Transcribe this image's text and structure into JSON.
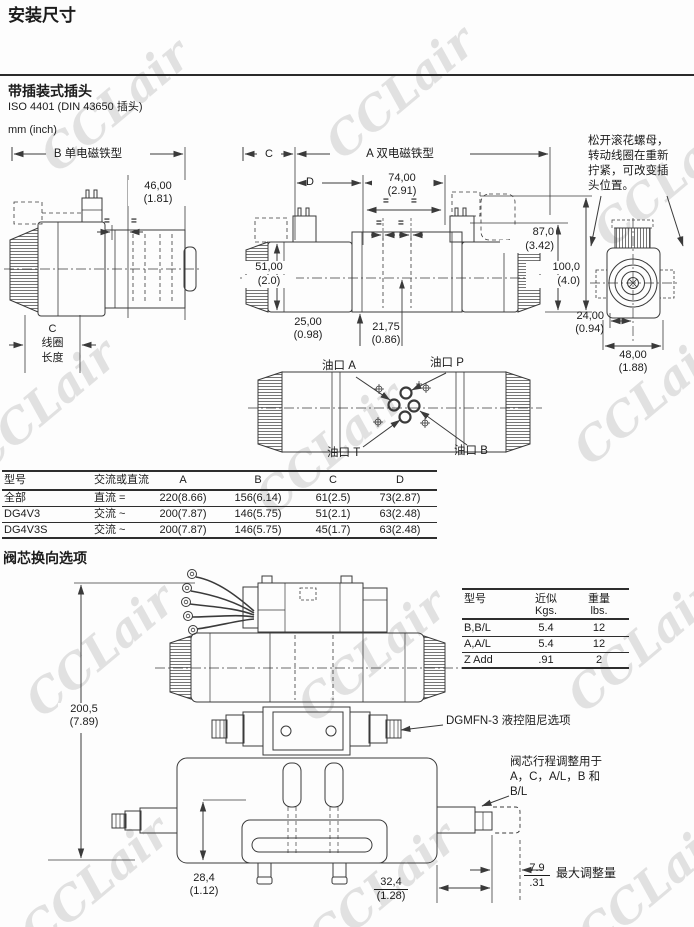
{
  "page": {
    "title": "安装尺寸",
    "watermark": "CCLair"
  },
  "section1": {
    "heading": "带插装式插头",
    "standard": "ISO 4401 (DIN 43650 插头)",
    "units": "mm (inch)",
    "fig_single": {
      "label": "B 单电磁铁型",
      "dim46": "46,00",
      "dim46_in": "(1.81)",
      "eq": "=",
      "coil_c": "C",
      "coil_line1": "线圈",
      "coil_line2": "长度"
    },
    "fig_double": {
      "label": "A 双电磁铁型",
      "dim_c": "C",
      "dim_d": "D",
      "dim74": "74,00",
      "dim74_in": "(2.91)",
      "eq": "=",
      "dim87": "87,0",
      "dim87_in": "(3.42)",
      "dim100": "100,0",
      "dim100_in": "(4.0)",
      "dim51": "51,00",
      "dim51_in": "(2.0)",
      "dim25": "25,00",
      "dim25_in": "(0.98)",
      "dim2175": "21,75",
      "dim2175_in": "(0.86)"
    },
    "fig_end": {
      "note1": "松开滚花螺母，",
      "note2": "转动线圈在重新",
      "note3": "拧紧，可改变插",
      "note4": "头位置。",
      "dim24": "24,00",
      "dim24_in": "(0.94)",
      "dim48": "48,00",
      "dim48_in": "(1.88)"
    },
    "fig_ports": {
      "port_a": "油口 A",
      "port_p": "油口 P",
      "port_t": "油口 T",
      "port_b": "油口 B"
    }
  },
  "dim_table": {
    "headers": [
      "型号",
      "交流或直流",
      "A",
      "B",
      "C",
      "D"
    ],
    "rows": [
      [
        "全部",
        "直流 =",
        "220(8.66)",
        "156(6.14)",
        "61(2.5)",
        "73(2.87)"
      ],
      [
        "DG4V3",
        "交流 ~",
        "200(7.87)",
        "146(5.75)",
        "51(2.1)",
        "63(2.48)"
      ],
      [
        "DG4V3S",
        "交流 ~",
        "200(7.87)",
        "146(5.75)",
        "45(1.7)",
        "63(2.48)"
      ]
    ]
  },
  "section2": {
    "heading": "阀芯换向选项",
    "dim2005": "200,5",
    "dim2005_in": "(7.89)",
    "dim284": "28,4",
    "dim284_in": "(1.12)",
    "dim324": "32,4",
    "dim324_in": "(1.28)",
    "dim79_num": "7.9",
    "dim79_den": ".31",
    "dim79_note": "最大调整量",
    "dgmfn_note": "DGMFN-3 液控阻尼选项",
    "stroke_note1": "阀芯行程调整用于",
    "stroke_note2": "A，C，A/L，B 和",
    "stroke_note3": "B/L",
    "weight_table": {
      "col1": "型号",
      "col2_l1": "近似",
      "col2_l2": "Kgs.",
      "col3_l1": "重量",
      "col3_l2": "lbs.",
      "rows": [
        [
          "B,B/L",
          "5.4",
          "12"
        ],
        [
          "A,A/L",
          "5.4",
          "12"
        ],
        [
          "Z Add",
          ".91",
          "2"
        ]
      ]
    }
  }
}
